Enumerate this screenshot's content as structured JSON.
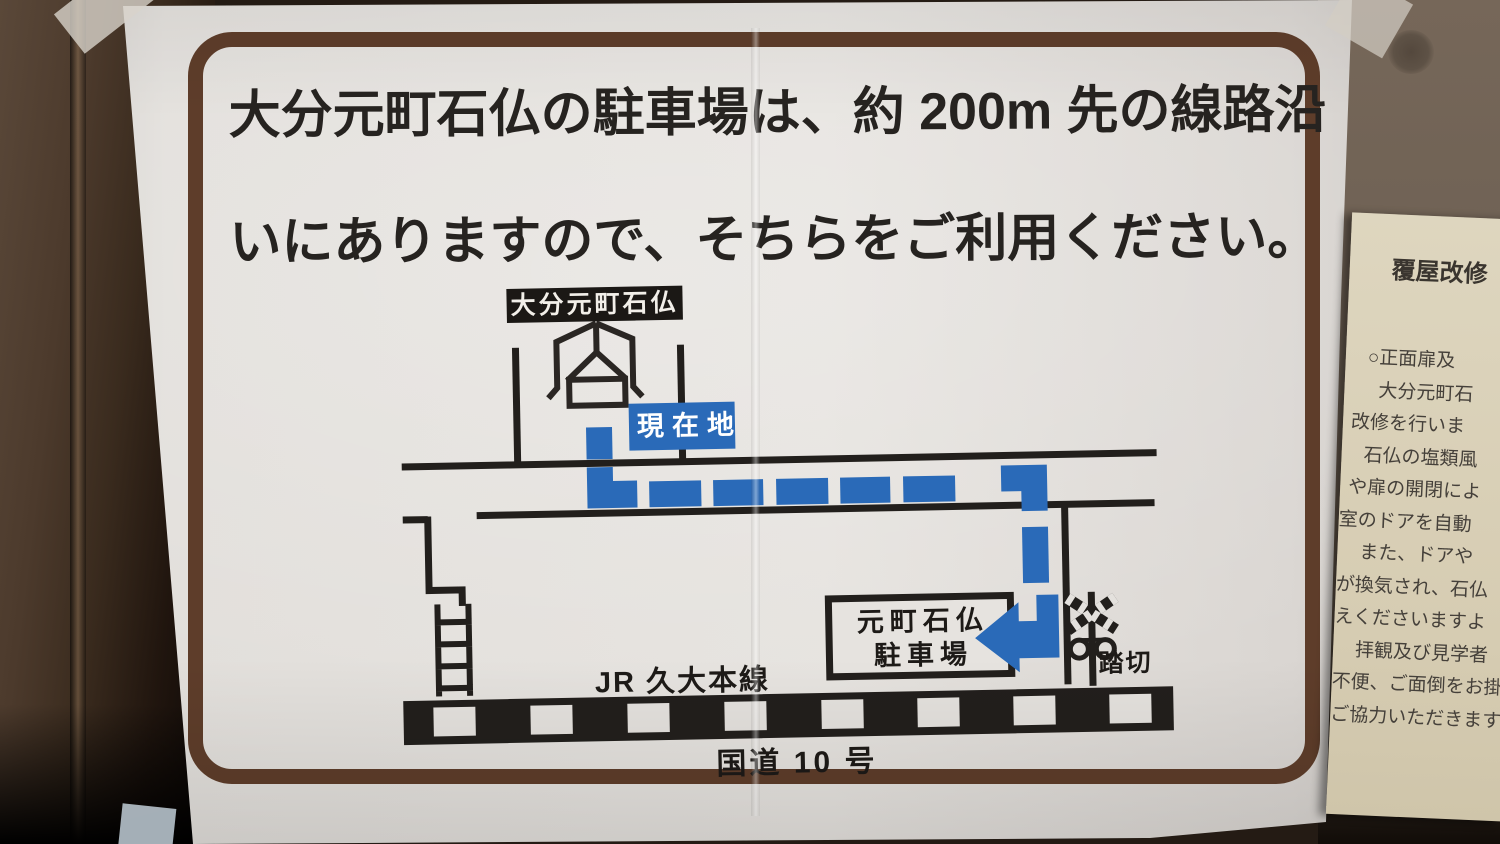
{
  "sign": {
    "headline_line1": "大分元町石仏の駐車場は、約 200m 先の線路沿",
    "headline_line2": "いにありますので、そちらをご利用ください。",
    "map": {
      "shrine_label": "大分元町石仏",
      "current_location_label": "現在地",
      "parking_label_line1": "元町石仏",
      "parking_label_line2": "駐車場",
      "crossing_label": "踏切",
      "railway_label": "JR 久大本線",
      "national_route_label": "国道 10 号",
      "icons": [
        "shrine-icon",
        "stairs-icon",
        "railroad-crossing-icon",
        "route-arrow-icon",
        "railway-track"
      ],
      "colors": {
        "route_blue": "#2a6ab8",
        "ink_black": "#221f1c",
        "frame_brown": "#5e3d2a"
      }
    }
  },
  "side_notice": {
    "title": "覆屋改修",
    "lines": [
      "○正面扉及",
      "大分元町石",
      "改修を行いま",
      "石仏の塩類風",
      "や扉の開閉によ",
      "室のドアを自動",
      "また、ドアや",
      "が換気され、石仏",
      "えくださいますよ",
      "拝観及び見学者",
      "不便、ご面倒をお掛",
      "ご協力いただきます"
    ]
  }
}
